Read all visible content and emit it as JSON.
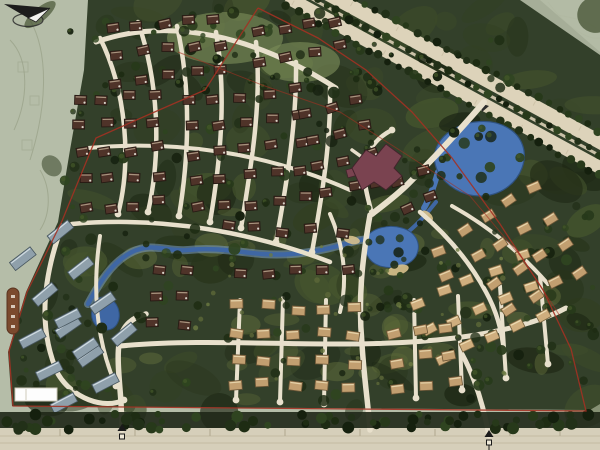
{
  "meta": {
    "kind": "architectural-site-plan-rendering",
    "compass_glyph": "N"
  },
  "map": {
    "viewport": {
      "w": 600,
      "h": 450
    },
    "colors": {
      "pale_outside": "#b5bda8",
      "pale_corner": "#b2baa4",
      "sketch": "#97a086",
      "veg_base": "#33402a",
      "veg_dark": [
        "#1d2714",
        "#28341b",
        "#323f22",
        "#3c4a29",
        "#46552e"
      ],
      "veg_light": [
        "#5c6838",
        "#6d7a42"
      ],
      "tree_dark": [
        "#15200e",
        "#1e2c13",
        "#27391a",
        "#2f4420",
        "#223018"
      ],
      "meadow": "#7a8a58",
      "road_fill": "#e8e0cc",
      "road_tick": "#b0a78d",
      "highway_fill": "#ddd3ba",
      "highway_median": "#c9c0a7",
      "highway_tick": "#c8bda1",
      "bottom_road": "#d6cfba",
      "bottom_lane": "#c4bba2",
      "water_core": "#3f67a4",
      "water_edge": "#7fa3cf",
      "water_stroke": "#2f5280",
      "lake_fill": "#4a76b6",
      "beach": "#d8c18c",
      "boundary_red": "#a33122",
      "clubhouse_fill": "#7a4350",
      "clubhouse_stroke": "#43242c",
      "capsule_fill": "#7b4a2e",
      "capsule_stroke": "#5a3420",
      "scalebar_fill": "#fdfdfd",
      "scalebar_stroke": "#cfcabb",
      "gate_dark": "#1a1a1a",
      "compass_dark": "#1c1c1c",
      "compass_light": "#f2f2ef"
    },
    "vegetation_outline": "M 88,0 L 540,0 L 600,52 L 600,404 L 590,410 L 12,406 L 8,352 L 26,292 L 58,222 L 70,150 L 84,70 Z",
    "pale_corner_poly": "520,0 600,0 600,55",
    "meadow_patches": [
      {
        "cx": 225,
        "cy": 38,
        "rx": 58,
        "ry": 26
      },
      {
        "cx": 300,
        "cy": 62,
        "rx": 40,
        "ry": 20
      }
    ],
    "sketch_lines": [
      "M 10,40 C 30,60 28,100 14,130",
      "M 30,20 C 50,55 46,110 30,160",
      "M 40,170 C 52,190 50,215 40,230",
      "M 530,8 C 556,18 576,14 596,28",
      "M 548,2 C 568,30 590,40 600,38",
      "M 500,30 C 520,46 540,44 560,60"
    ],
    "sketch_squares": [
      {
        "x": 18,
        "y": 62,
        "s": 10
      },
      {
        "x": 30,
        "y": 96,
        "s": 9
      },
      {
        "x": 22,
        "y": 140,
        "s": 10
      }
    ],
    "texture": {
      "dark_n": 130,
      "light_n": 30
    },
    "tree_regions": [
      {
        "x": 60,
        "y": 8,
        "w": 300,
        "h": 215,
        "n": 55
      },
      {
        "x": 150,
        "y": 8,
        "w": 230,
        "h": 90,
        "n": 30
      },
      {
        "x": 360,
        "y": 40,
        "w": 160,
        "h": 160,
        "n": 40
      },
      {
        "x": 470,
        "y": 190,
        "w": 125,
        "h": 200,
        "n": 40
      },
      {
        "x": 60,
        "y": 225,
        "w": 450,
        "h": 180,
        "n": 70
      },
      {
        "x": 10,
        "y": 300,
        "w": 80,
        "h": 100,
        "n": 18
      },
      {
        "x": 330,
        "y": 200,
        "w": 120,
        "h": 110,
        "n": 25
      }
    ],
    "light_dot_region": {
      "x": 180,
      "y": 240,
      "w": 330,
      "h": 150,
      "n": 40
    },
    "highway": {
      "start": [
        292,
        -12
      ],
      "end": [
        630,
        172
      ],
      "band_offsets": [
        -12,
        10.5
      ],
      "band_widths": [
        14,
        13
      ],
      "tree_row_offsets": [
        -21,
        -1,
        18
      ],
      "tree_step": 11.5,
      "tick_step": 26,
      "tick_offsets": [
        -12,
        10
      ]
    },
    "entry_branch_island": {
      "x": 480,
      "y": 103
    },
    "bottom_road": {
      "y_top": 428,
      "lane_ys": [
        436,
        443
      ],
      "tick_xs": [
        60,
        135,
        210,
        285,
        360,
        435,
        510,
        560
      ],
      "tree_band_y": 412,
      "tree_band_h": 16,
      "tree_n": 70
    },
    "water": {
      "lake": "M 438,172 C 430,156 436,140 452,130 C 468,120 492,118 508,128 C 522,136 528,152 522,168 C 516,184 500,196 480,196 C 462,196 446,186 438,172 Z",
      "lake_tail": "M 438,172 C 434,186 430,198 424,208",
      "pond": "M 366,238 C 372,228 388,224 402,228 C 416,232 422,244 416,256 C 410,266 394,270 380,266 C 368,262 362,250 366,238 Z",
      "west_pond": "M 95,300 C 104,294 114,298 118,308 C 122,320 116,330 106,330 C 96,330 90,320 92,310 Z",
      "stream_main": "M 88,304 C 100,282 112,262 132,252 C 152,242 168,252 188,250 C 214,247 238,252 262,254 C 290,256 316,252 338,246 C 352,242 362,238 372,240",
      "stream_ne": "M 408,232 C 420,222 428,212 436,202",
      "beaches": [
        {
          "cx": 398,
          "cy": 270,
          "rx": 11,
          "ry": 5,
          "rot": -15
        },
        {
          "cx": 427,
          "cy": 216,
          "rx": 7,
          "ry": 4,
          "rot": 40
        },
        {
          "cx": 352,
          "cy": 240,
          "rx": 8,
          "ry": 4,
          "rot": 10
        }
      ]
    },
    "roads": [
      {
        "d": "M 100,38 C 126,90 132,160 118,214",
        "w": 4.5
      },
      {
        "d": "M 138,22 C 158,80 162,150 148,212",
        "w": 4.5
      },
      {
        "d": "M 177,26 C 190,85 190,150 179,216",
        "w": 4.5
      },
      {
        "d": "M 216,32 C 226,90 222,152 210,222",
        "w": 4.5
      },
      {
        "d": "M 256,42 C 262,100 252,162 241,228",
        "w": 4.5
      },
      {
        "d": "M 296,62 C 297,120 287,182 276,242",
        "w": 4.5
      },
      {
        "d": "M 330,88 C 331,142 322,196 312,252",
        "w": 4.5
      },
      {
        "d": "M 96,42 C 170,16 255,36 336,88",
        "w": 5
      },
      {
        "d": "M 88,148 C 175,140 265,152 350,190",
        "w": 4
      },
      {
        "d": "M 72,224 C 162,216 252,232 330,262",
        "w": 4.5
      },
      {
        "d": "M 62,226 C 42,280 38,330 58,374 C 72,398 104,410 124,400",
        "w": 5
      },
      {
        "d": "M 100,236 C 92,290 96,340 116,386",
        "w": 4
      },
      {
        "d": "M 122,430 L 121,402 C 119,376 117,358 119,344 C 121,328 130,318 146,314",
        "w": 5.5
      },
      {
        "d": "M 370,215 C 362,260 358,300 362,344 C 364,378 368,402 370,430",
        "w": 5.5
      },
      {
        "d": "M 120,346 C 230,336 340,352 455,338 C 500,332 540,322 566,308",
        "w": 5
      },
      {
        "d": "M 240,300 L 236,400",
        "w": 4
      },
      {
        "d": "M 283,298 L 280,402",
        "w": 4
      },
      {
        "d": "M 326,300 L 324,404",
        "w": 4
      },
      {
        "d": "M 414,300 L 416,398",
        "w": 4
      },
      {
        "d": "M 458,296 L 462,390",
        "w": 4
      },
      {
        "d": "M 500,286 L 506,378",
        "w": 4
      },
      {
        "d": "M 540,276 L 548,364",
        "w": 4
      },
      {
        "d": "M 420,212 C 448,236 470,262 486,292 C 496,310 502,330 504,352",
        "w": 4.5
      },
      {
        "d": "M 484,102 C 460,130 434,158 408,184 C 396,196 382,206 372,214",
        "w": 6
      },
      {
        "d": "M 330,214 C 344,246 348,280 340,312",
        "w": 4
      },
      {
        "d": "M 372,214 C 366,192 362,176 366,160 C 370,146 380,136 392,130",
        "w": 4.5
      },
      {
        "d": "M 366,160 L 352,150",
        "w": 3.5
      },
      {
        "d": "M 489,436 C 484,408 476,380 462,354",
        "w": 5
      },
      {
        "d": "M 452,206 C 488,226 520,252 548,284",
        "w": 4
      }
    ],
    "culdesacs": [
      [
        118,
        214
      ],
      [
        148,
        212
      ],
      [
        179,
        216
      ],
      [
        210,
        222
      ],
      [
        241,
        228
      ],
      [
        276,
        242
      ],
      [
        312,
        252
      ],
      [
        236,
        400
      ],
      [
        280,
        402
      ],
      [
        324,
        404
      ],
      [
        416,
        398
      ],
      [
        462,
        390
      ],
      [
        506,
        378
      ],
      [
        548,
        364
      ],
      [
        124,
        400
      ],
      [
        116,
        386
      ],
      [
        392,
        130
      ]
    ],
    "house_styles": {
      "maroon": {
        "fill": "#4f3329",
        "stroke": "#241812",
        "hl": "#b9a68e",
        "w": 12,
        "h": 9
      },
      "tan": {
        "fill": "#c29f70",
        "stroke": "#6b5536",
        "hl": "#ecdcb4",
        "w": 13,
        "h": 9
      },
      "tan2": {
        "fill": "#cfae7e",
        "stroke": "#75603c",
        "hl": "#f2e4bd",
        "w": 13,
        "h": 9
      },
      "bluegray": {
        "fill": "#8fa0ab",
        "stroke": "#46555e",
        "hl": "#dde7ec",
        "w": 26,
        "h": 10
      }
    },
    "clusters": [
      {
        "name": "nw-a",
        "x": 112,
        "y": 28,
        "cols": 5,
        "rows": 3,
        "dx": 26,
        "dy": 27,
        "angle": -6,
        "style": "maroon"
      },
      {
        "name": "nw-b",
        "x": 78,
        "y": 100,
        "cols": 4,
        "rows": 5,
        "dx": 25,
        "dy": 27,
        "angle": -4,
        "style": "maroon"
      },
      {
        "name": "nw-c",
        "x": 188,
        "y": 100,
        "cols": 5,
        "rows": 5,
        "dx": 27,
        "dy": 27,
        "angle": -5,
        "style": "maroon"
      },
      {
        "name": "n-d",
        "x": 256,
        "y": 34,
        "cols": 4,
        "rows": 2,
        "dx": 27,
        "dy": 27,
        "angle": -10,
        "style": "maroon"
      },
      {
        "name": "n-e",
        "x": 306,
        "y": 112,
        "cols": 3,
        "rows": 4,
        "dx": 27,
        "dy": 28,
        "angle": -14,
        "style": "maroon"
      },
      {
        "name": "c-above-stream",
        "x": 228,
        "y": 228,
        "cols": 5,
        "rows": 1,
        "dx": 28,
        "dy": 28,
        "angle": 2,
        "style": "maroon"
      },
      {
        "name": "c-below-stream",
        "x": 238,
        "y": 274,
        "cols": 5,
        "rows": 1,
        "dx": 28,
        "dy": 28,
        "angle": -2,
        "style": "maroon"
      },
      {
        "name": "w-stream",
        "x": 158,
        "y": 268,
        "cols": 2,
        "rows": 3,
        "dx": 28,
        "dy": 28,
        "angle": 4,
        "style": "maroon"
      },
      {
        "name": "ne-lake",
        "x": 396,
        "y": 182,
        "cols": 2,
        "rows": 2,
        "dx": 27,
        "dy": 26,
        "angle": -20,
        "style": "maroon"
      },
      {
        "name": "east",
        "x": 464,
        "y": 230,
        "cols": 4,
        "rows": 4,
        "dx": 27,
        "dy": 31,
        "angle": -30,
        "style": "tan"
      },
      {
        "name": "se",
        "x": 418,
        "y": 302,
        "cols": 5,
        "rows": 3,
        "dx": 28,
        "dy": 31,
        "angle": -24,
        "style": "tan2"
      },
      {
        "name": "s-center",
        "x": 238,
        "y": 306,
        "cols": 5,
        "rows": 4,
        "dx": 29,
        "dy": 26,
        "angle": 2,
        "style": "tan"
      },
      {
        "name": "s-mid",
        "x": 392,
        "y": 334,
        "cols": 3,
        "rows": 3,
        "dx": 28,
        "dy": 27,
        "angle": -8,
        "style": "tan"
      },
      {
        "name": "sw-rowhouses",
        "x": 22,
        "y": 258,
        "cols": 2,
        "rows": 4,
        "dx": 46,
        "dy": 40,
        "angle": -33,
        "style": "bluegray"
      },
      {
        "name": "sw-rowhouses-b",
        "x": 30,
        "y": 338,
        "cols": 2,
        "rows": 3,
        "dx": 44,
        "dy": 36,
        "angle": -28,
        "style": "bluegray"
      },
      {
        "name": "lake-south",
        "x": 436,
        "y": 250,
        "cols": 1,
        "rows": 2,
        "dx": 26,
        "dy": 30,
        "angle": -25,
        "style": "tan"
      }
    ],
    "clubhouse": {
      "d": "M 352,168 L 366,150 L 376,156 L 386,144 L 402,156 L 394,168 L 402,176 L 386,190 L 374,182 L 362,190 Z",
      "wing": {
        "x": 346,
        "y": 170,
        "w": 11,
        "h": 8,
        "rot": -15
      }
    },
    "red_boundary": "M 258,8 L 205,90 L 150,114 L 96,138 L 62,221 L 27,292 L 9,351 L 13,406 L 586,411 L 571,349 L 543,290 L 500,224 L 452,158 L 412,112 L 366,70 L 318,38 L 258,8",
    "red_inner": "M 178,52 L 262,85 L 340,112 L 412,158 L 470,196 L 522,258 L 560,316",
    "capsule_label": {
      "x": 7,
      "y": 288,
      "w": 12,
      "h": 46,
      "ticks": 4
    },
    "scale_bar": {
      "x": 15,
      "y": 388,
      "w": 42,
      "h": 13,
      "divider_x": 26
    },
    "gates": [
      {
        "x": 122,
        "y": 431,
        "pole": false
      },
      {
        "x": 489,
        "y": 437,
        "pole": true
      }
    ],
    "compass": {
      "x": 30,
      "y": 12
    }
  }
}
